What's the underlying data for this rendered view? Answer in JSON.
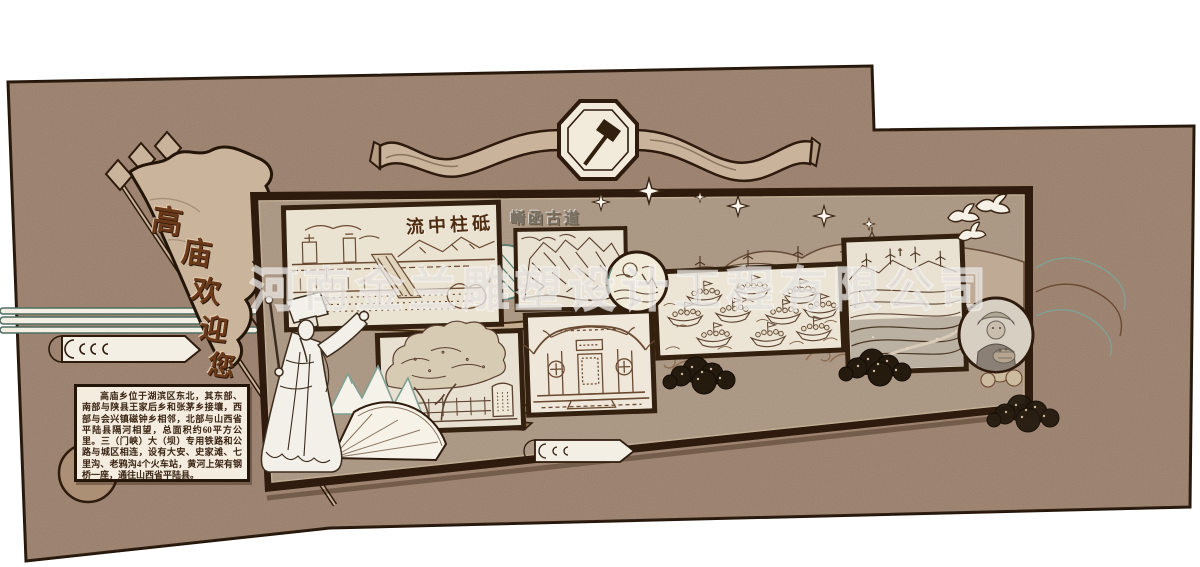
{
  "watermark": {
    "text": "河南金兰雕塑设计工程有限公司"
  },
  "flag": {
    "text": "高庙欢迎您",
    "chars": [
      "高",
      "庙",
      "欢",
      "迎",
      "您"
    ]
  },
  "panels": {
    "dam": {
      "title": "流中柱砥"
    },
    "ancient_road": {
      "title": "崤函古道"
    }
  },
  "infobox": {
    "text": "高庙乡位于湖滨区东北，其东部、南部与陕县王家后乡和张茅乡接壤，西部与会兴镇磁钟乡相邻，北部与山西省平陆县隔河相望，总面积约60平方公里。三（门峡）大（坝）专用铁路和公路与城区相连，设有大安、史家滩、七里沟、老鸦沟4个火车站，黄河上架有钢桥一座，通往山西省平陆县。"
  },
  "colors": {
    "wall": "#a58b79",
    "board_face": "#b3a08d",
    "frame": "#2e1b0d",
    "panel_mat": "#ebe3d2",
    "ink": "#5c4230",
    "teal": "#5b7d72",
    "flag_text": "#6b3a1a",
    "watermark": "#ffffff"
  },
  "icons": [
    "hammer-and-sickle-icon",
    "sparkle-star-icon",
    "dove-icon",
    "wind-turbine-icon",
    "spear-flag-icon"
  ]
}
